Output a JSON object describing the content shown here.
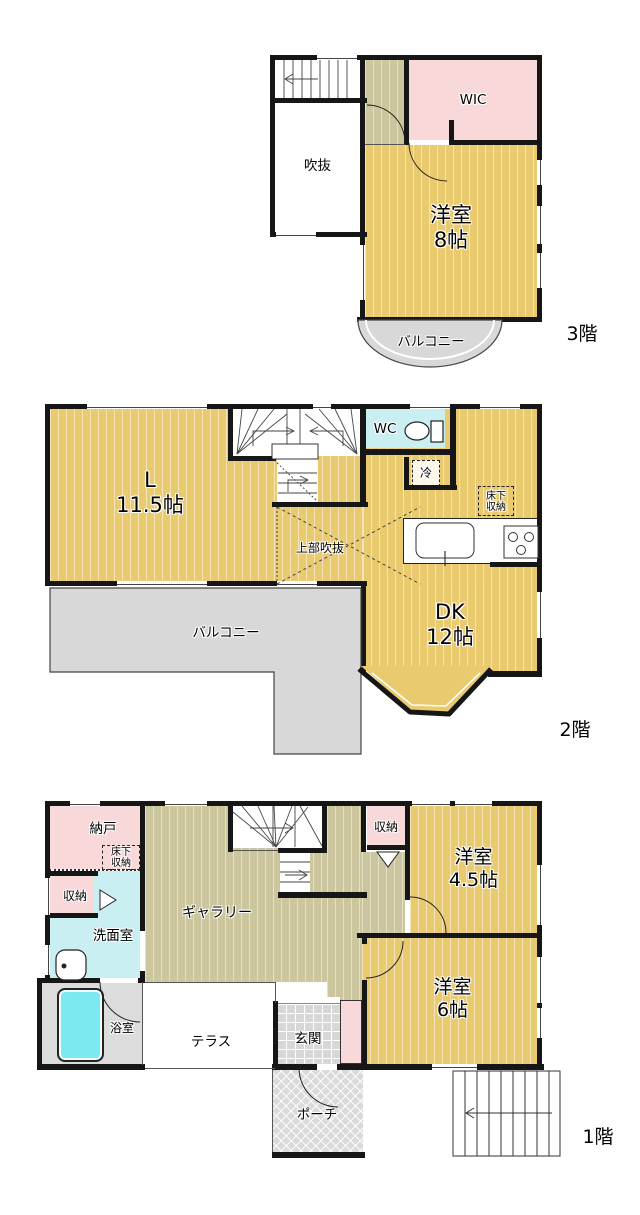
{
  "palette": {
    "room_yellow": "#EACA6F",
    "hall_olive": "#CBC69D",
    "closet_pink": "#F8D8D8",
    "wet_area_cyan": "#C9EFF2",
    "bathtub_cyan": "#7CE8EF",
    "outdoor_gray": "#D8D8D8",
    "wall_black": "#161616"
  },
  "floor3": {
    "label": "3階",
    "void": "吹抜",
    "wic": "WIC",
    "western8": {
      "name": "洋室",
      "size": "8帖"
    },
    "balcony": "バルコニー"
  },
  "floor2": {
    "label": "2階",
    "living": {
      "name": "L",
      "size": "11.5帖"
    },
    "wc": "WC",
    "fridge": "冷",
    "underfloor": {
      "line1": "床下",
      "line2": "収納"
    },
    "upper_void": "上部吹抜",
    "dk": {
      "name": "DK",
      "size": "12帖"
    },
    "balcony": "バルコニー"
  },
  "floor1": {
    "label": "1階",
    "storeroom": "納戸",
    "underfloor": {
      "line1": "床下",
      "line2": "収納"
    },
    "closet_left": "収納",
    "washroom": "洗面室",
    "bathroom": "浴室",
    "gallery": "ギャラリー",
    "terrace": "テラス",
    "entrance": "玄関",
    "closet_right": "収納",
    "western45": {
      "name": "洋室",
      "size": "4.5帖"
    },
    "western6": {
      "name": "洋室",
      "size": "6帖"
    },
    "porch": "ポーチ"
  }
}
